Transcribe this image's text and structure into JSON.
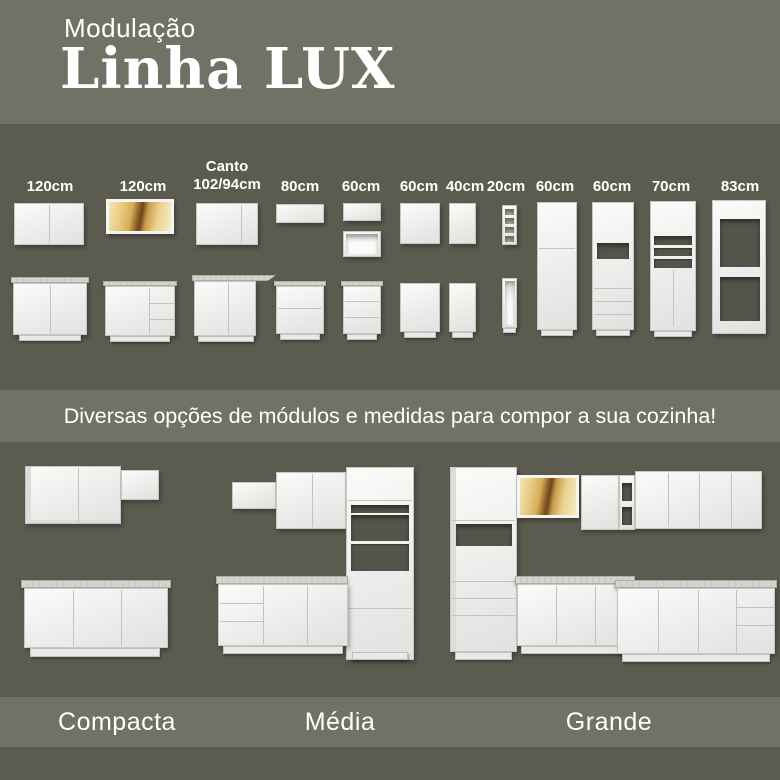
{
  "header": {
    "subtitle": "Modulação",
    "title": "Linha LUX"
  },
  "modules_section": {
    "items": [
      {
        "label": "120cm",
        "depicts": "wall cabinet with 2 doors + base cabinet with 2 doors"
      },
      {
        "label": "120cm",
        "depicts": "wall cabinet with amber glass doors + base cabinet with doors and drawers"
      },
      {
        "label_line1": "Canto",
        "label_line2": "102/94cm",
        "depicts": "corner wall cabinet + corner base cabinet with extended counter"
      },
      {
        "label": "80cm",
        "depicts": "low wall cabinet + base cabinet with 2 drawers"
      },
      {
        "label": "60cm",
        "depicts": "low wall cabinet + open wall niche + base cabinet with 3 drawers"
      },
      {
        "label": "60cm",
        "depicts": "wall cabinet 1 door + base cabinet 1 door"
      },
      {
        "label": "40cm",
        "depicts": "narrow wall cabinet 1 door + narrow base cabinet 1 door"
      },
      {
        "label": "20cm",
        "depicts": "narrow open-shelf wall tower + narrow open base unit"
      },
      {
        "label": "60cm",
        "depicts": "tall pantry cabinet with stacked doors"
      },
      {
        "label": "60cm",
        "depicts": "tall cabinet with microwave niche and drawers"
      },
      {
        "label": "70cm",
        "depicts": "tall cabinet with open shelves and lower doors"
      },
      {
        "label": "83cm",
        "depicts": "tall open oven/appliance tower frame"
      }
    ]
  },
  "banner": {
    "text": "Diversas opções de módulos e medidas para compor a sua cozinha!"
  },
  "kitchens_section": {
    "items": [
      {
        "name": "Compacta",
        "depicts": "small kitchen: stepped wall cabinets and 3-door base counter"
      },
      {
        "name": "Média",
        "depicts": "medium kitchen: wall cabinets, tall open tower, base run with drawers and doors"
      },
      {
        "name": "Grande",
        "depicts": "large L-shaped kitchen: tall tower, amber glass cabinet, corner shelves, long base runs"
      }
    ]
  },
  "colors": {
    "band_light": "#6e7365",
    "band_dark": "#5c5b4f",
    "text_white": "#ffffff",
    "cabinet_white": "#f2f2f0",
    "counter_gray": "#d2d3ca",
    "amber_glass": "#ddb76a",
    "amber_shadow": "#7c5224"
  }
}
